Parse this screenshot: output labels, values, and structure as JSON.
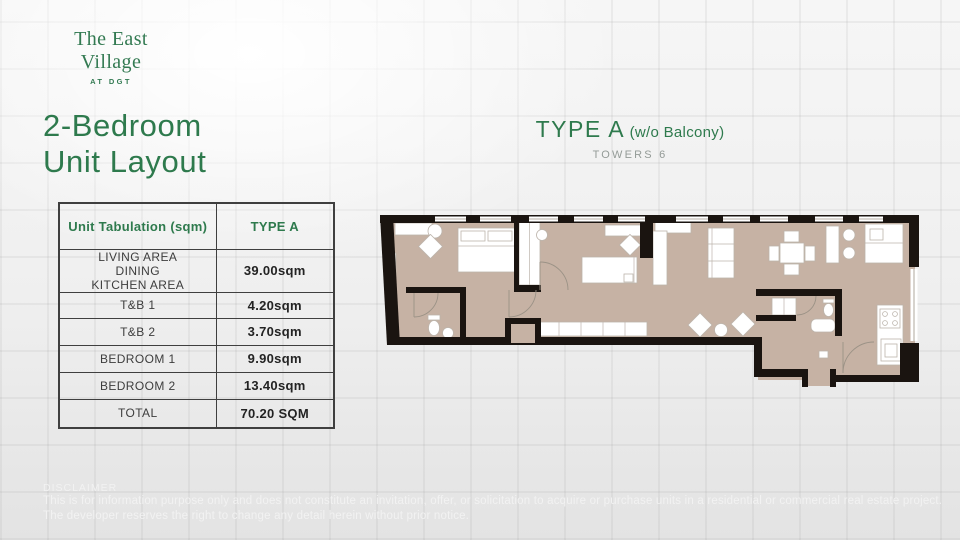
{
  "brand": {
    "name": "The East Village",
    "tagline": "AT DGT"
  },
  "page_title": {
    "line1": "2-Bedroom",
    "line2": "Unit Layout"
  },
  "plan_header": {
    "title": "TYPE A",
    "qualifier": "(w/o Balcony)",
    "towers": "TOWERS 6"
  },
  "unit_table": {
    "headers": [
      "Unit Tabulation (sqm)",
      "TYPE A"
    ],
    "rows": [
      {
        "label": "LIVING AREA\nDINING\nKITCHEN AREA",
        "value": "39.00sqm"
      },
      {
        "label": "T&B 1",
        "value": "4.20sqm"
      },
      {
        "label": "T&B 2",
        "value": "3.70sqm"
      },
      {
        "label": "BEDROOM 1",
        "value": "9.90sqm"
      },
      {
        "label": "BEDROOM 2",
        "value": "13.40sqm"
      },
      {
        "label": "TOTAL",
        "value": "70.20 SQM"
      }
    ]
  },
  "disclaimer": {
    "title": "DISCLAIMER",
    "line1": "This is for information purpose only and does not constitute an invitation, offer, or solicitation to acquire or purchase units in a residential or commercial real estate project.",
    "line2": "The developer reserves the right to change any detail herein without prior notice."
  },
  "colors": {
    "accent": "#2e7a4d",
    "logo-green": "#337a52",
    "towers-gray": "#949b97",
    "table-border": "#3f3f3f",
    "label-text": "#3d3d3d",
    "value-text": "#232323",
    "disclaimer-text": "#f2f2f2",
    "floor": "#c6b2a4",
    "wall": "#1a1410",
    "furniture-stroke": "#bcb4ab"
  },
  "floorplan": {
    "description": "2-bedroom unit floor plan, long horizontal layout",
    "features": [
      "double-bed",
      "wardrobe",
      "dresser",
      "armchair",
      "mirror",
      "toilet",
      "lavatory-sink",
      "bathtub",
      "single-bed",
      "closet",
      "sofa",
      "console",
      "coffee-table",
      "lounge-chairs",
      "dining-table",
      "dining-chairs",
      "bar-counter",
      "bar-stools",
      "kitchen-counter",
      "stove",
      "kitchen-sink",
      "entry-door",
      "windows"
    ]
  }
}
